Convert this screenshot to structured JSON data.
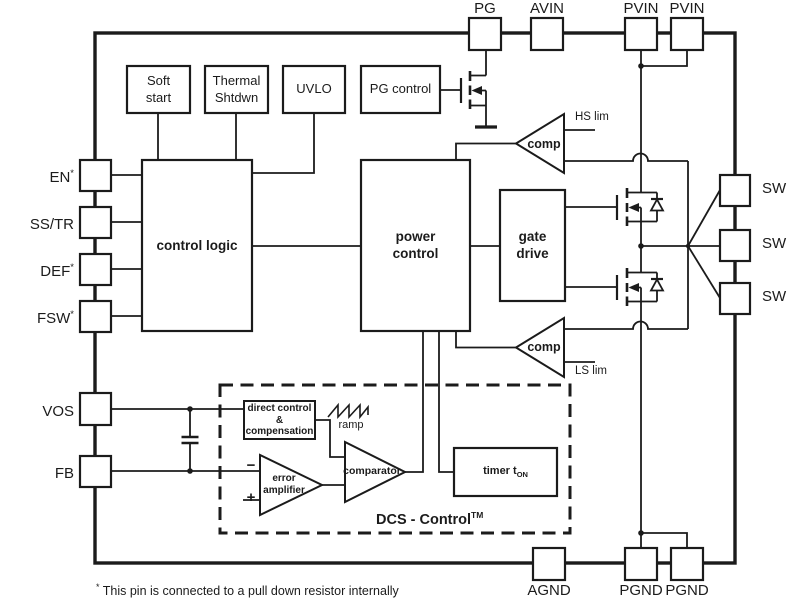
{
  "colors": {
    "line": "#1b1b1b",
    "background": "#ffffff"
  },
  "pins": {
    "top": [
      {
        "label": "PG"
      },
      {
        "label": "AVIN"
      },
      {
        "label": "PVIN"
      },
      {
        "label": "PVIN"
      }
    ],
    "left": [
      {
        "label": "EN",
        "sup": "*"
      },
      {
        "label": "SS/TR",
        "sup": ""
      },
      {
        "label": "DEF",
        "sup": "*"
      },
      {
        "label": "FSW",
        "sup": "*"
      },
      {
        "label": "VOS",
        "sup": ""
      },
      {
        "label": "FB",
        "sup": ""
      }
    ],
    "right": [
      {
        "label": "SW"
      },
      {
        "label": "SW"
      },
      {
        "label": "SW"
      }
    ],
    "bottom": [
      {
        "label": "AGND"
      },
      {
        "label": "PGND"
      },
      {
        "label": "PGND"
      }
    ]
  },
  "blocks": {
    "soft_start": {
      "line1": "Soft",
      "line2": "start"
    },
    "thermal_shutdown": {
      "line1": "Thermal",
      "line2": "Shtdwn"
    },
    "uvlo": {
      "label": "UVLO"
    },
    "pg_control": {
      "label": "PG control"
    },
    "control_logic": {
      "label": "control logic"
    },
    "power_control": {
      "line1": "power",
      "line2": "control"
    },
    "gate_drive": {
      "line1": "gate",
      "line2": "drive"
    },
    "hs_comparator": {
      "label": "comp"
    },
    "ls_comparator": {
      "label": "comp"
    },
    "direct_control": {
      "line1": "direct control",
      "line2": "&",
      "line3": "compensation"
    },
    "error_amplifier": {
      "line1": "error",
      "line2": "amplifier"
    },
    "comparator": {
      "label": "comparator"
    },
    "timer": {
      "label": "timer t",
      "sub": "ON"
    }
  },
  "annotations": {
    "hs_limit": "HS lim",
    "ls_limit": "LS lim",
    "ramp": "ramp",
    "minus": "−",
    "plus": "+",
    "dcs_control": "DCS - Control",
    "dcs_tm": "TM"
  },
  "footnote": {
    "marker": "*",
    "text": "This pin is connected to a pull down resistor internally"
  }
}
